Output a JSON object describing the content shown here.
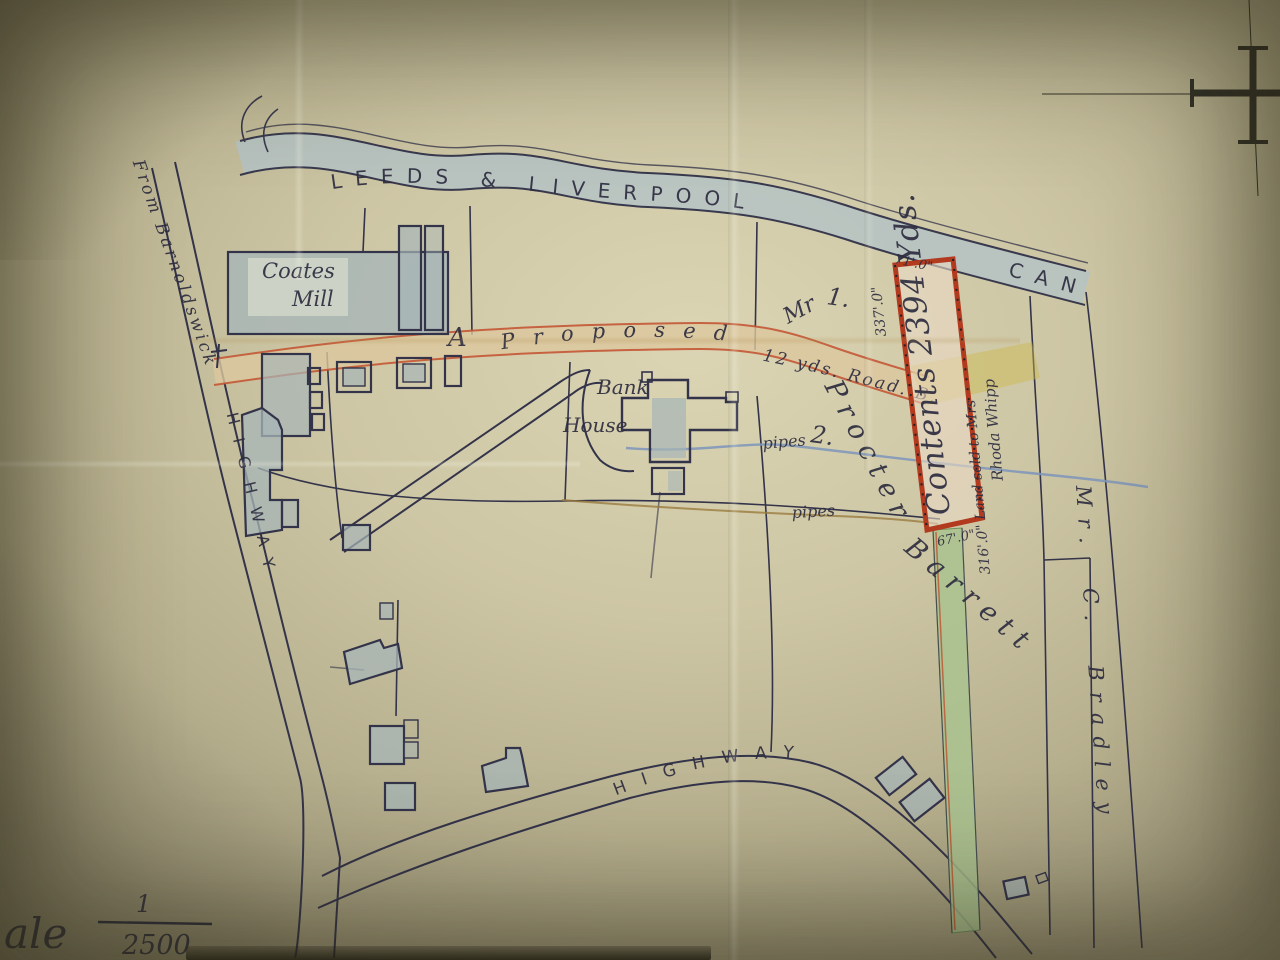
{
  "map": {
    "canal": {
      "name_main": "LEEDS & LIVERPOOL",
      "name_suffix": "CANAL"
    },
    "mill": {
      "name_line1": "Coates",
      "name_line2": "Mill"
    },
    "proposed_road": {
      "marker": "A",
      "name": "Proposed",
      "spec": "12 yds. Road. B."
    },
    "bank_house": {
      "line1": "Bank",
      "line2": "House"
    },
    "roads": {
      "from_road": "From Barnoldswick",
      "highway_west": "HIGHWAY",
      "highway_south": "HIGHWAY"
    },
    "plots": {
      "plot1_prefix": "Mr",
      "plot1_no": "1.",
      "plot2_no": "2."
    },
    "owners": {
      "owner1_first": "Procter",
      "owner1_last": "Barrett",
      "owner2": "Mr. C. Bradley"
    },
    "pipes": {
      "label_north": "pipes",
      "label_south": "pipes"
    },
    "parcel": {
      "contents": "Contents 2394 Yds.",
      "dim_west": "337'.0\"",
      "dim_east_line1": "316'.0\" Land sold to Mrs",
      "dim_east_line2": "Rhoda Whipp",
      "dim_south": "67'.0\"",
      "dim_north": "71'.0\""
    },
    "scale": {
      "label_partial": "ale",
      "fraction_numerator": "1",
      "fraction_denominator": "2500"
    }
  },
  "colors": {
    "paper": "#cdc6a4",
    "ink": "#2e2d40",
    "canal_fill": "#b5c3c4",
    "parcel_outline": "#b23a1e",
    "road_fill": "#dcc79d",
    "green_strip": "#a9c28f",
    "pipe_blue": "#7d94bb",
    "pipe_brown": "#9a7b3f",
    "building_fill": "#a7b5b7"
  }
}
